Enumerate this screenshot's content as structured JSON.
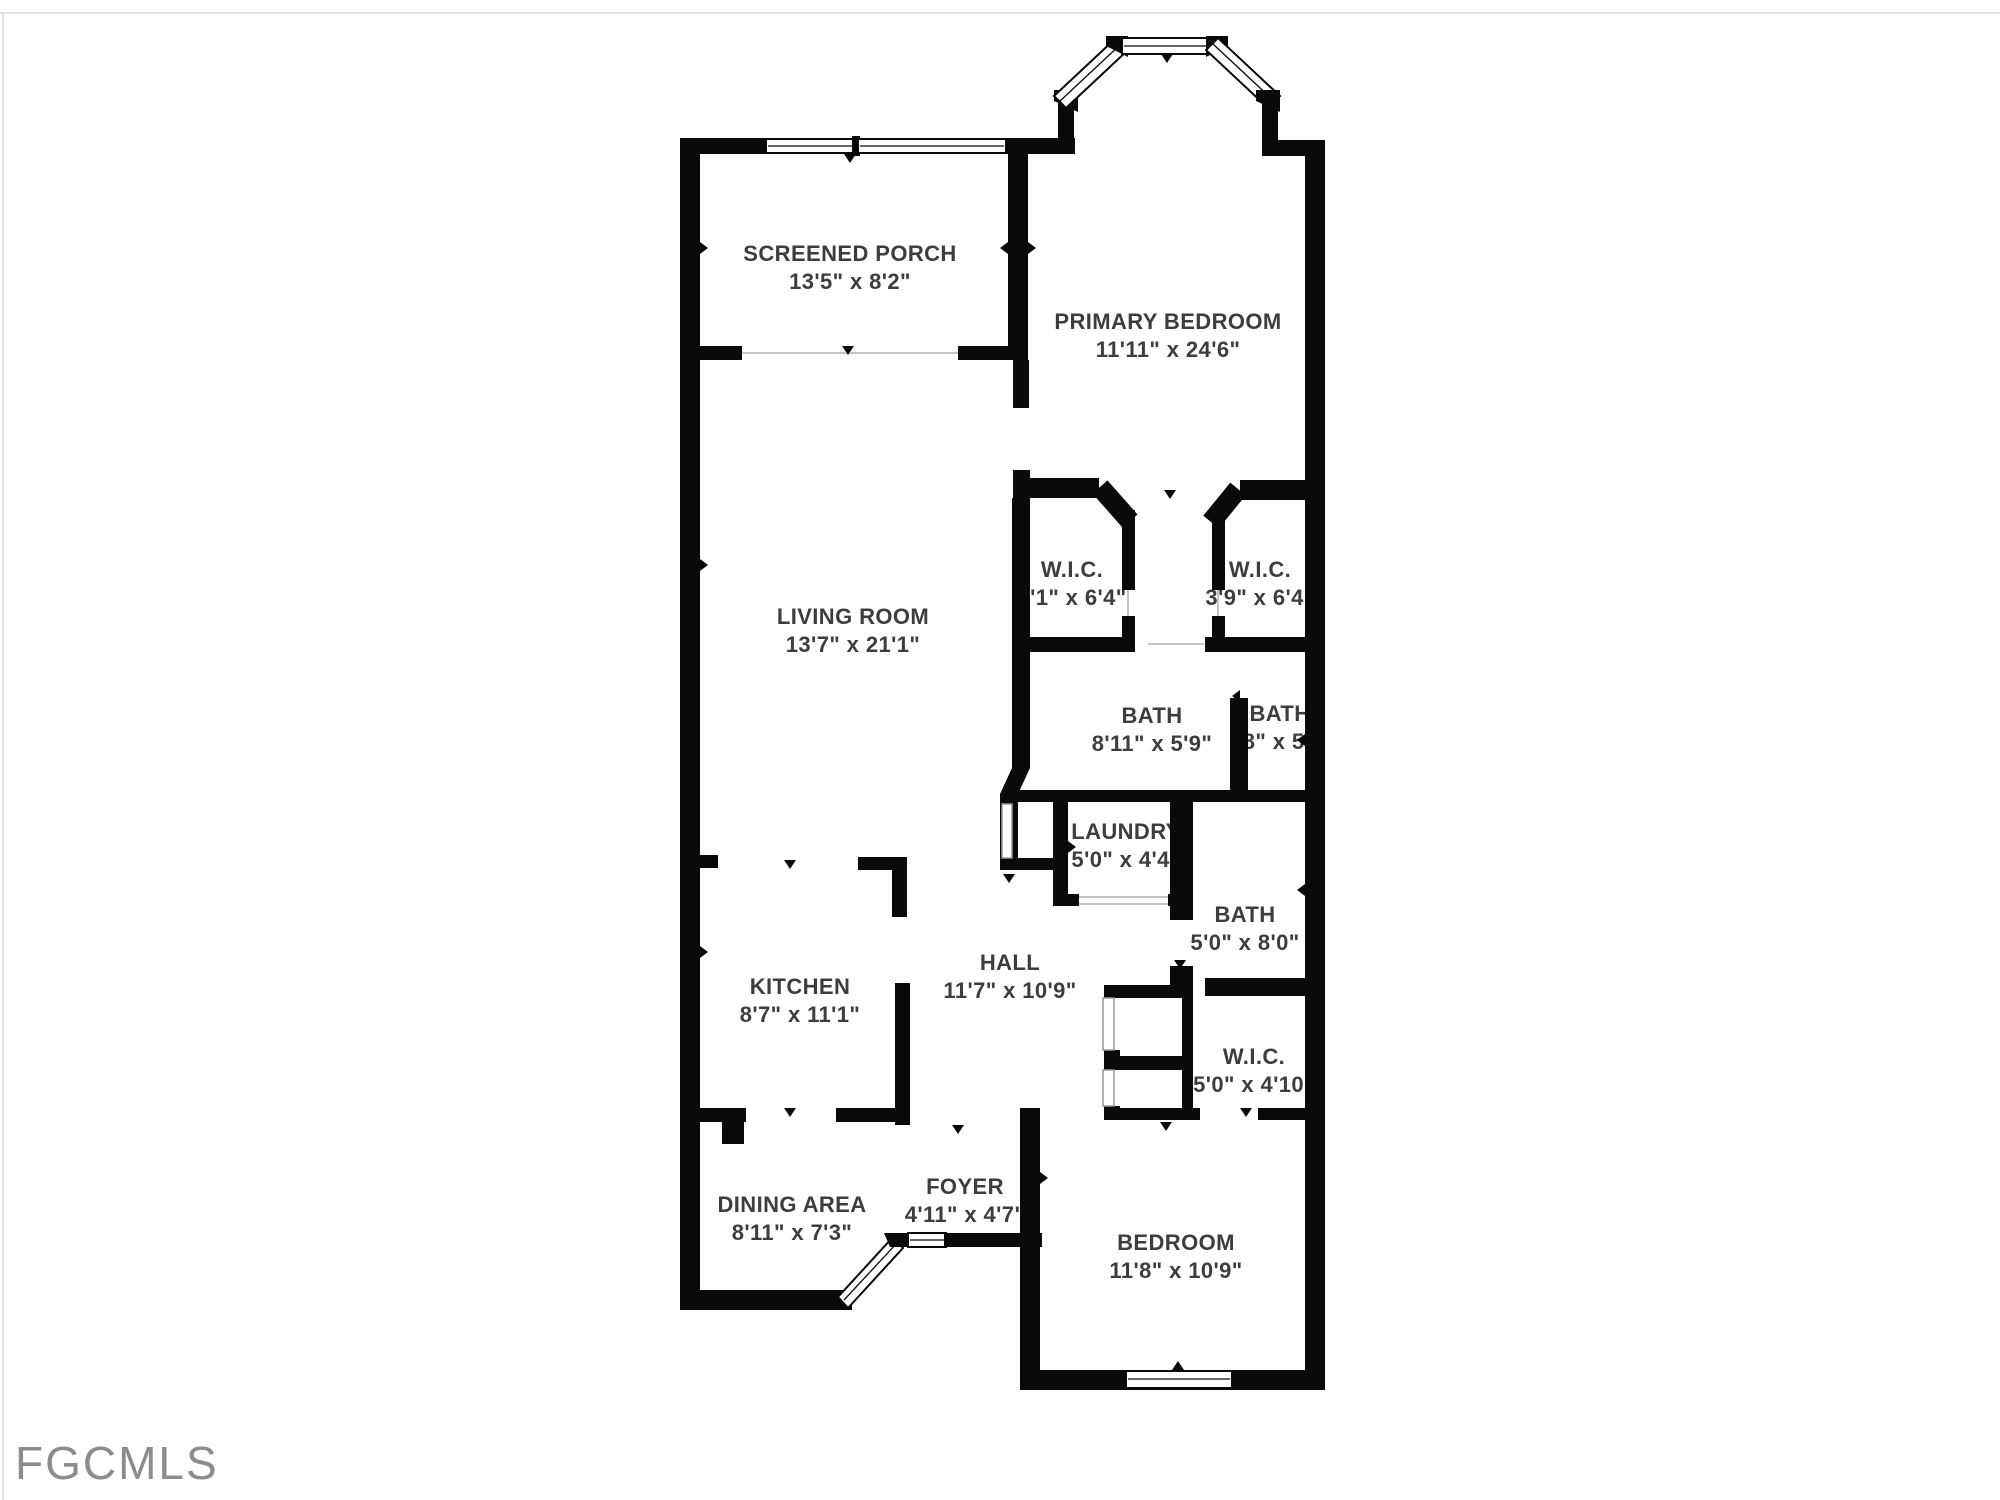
{
  "watermark": "FGCMLS",
  "plan": {
    "rooms": [
      {
        "name": "SCREENED PORCH",
        "dims": "13'5\" x 8'2\""
      },
      {
        "name": "PRIMARY BEDROOM",
        "dims": "11'11\" x 24'6\""
      },
      {
        "name": "LIVING ROOM",
        "dims": "13'7\" x 21'1\""
      },
      {
        "name": "W.I.C.",
        "dims": "4'1\" x 6'4\""
      },
      {
        "name": "W.I.C.",
        "dims": "3'9\" x 6'4\""
      },
      {
        "name": "BATH",
        "dims": "8'11\" x 5'9\""
      },
      {
        "name": "BATH",
        "dims": "'8\" x 5'9"
      },
      {
        "name": "LAUNDRY",
        "dims": "5'0\" x 4'4\""
      },
      {
        "name": "BATH",
        "dims": "5'0\" x 8'0\""
      },
      {
        "name": "HALL",
        "dims": "11'7\" x 10'9\""
      },
      {
        "name": "KITCHEN",
        "dims": "8'7\" x 11'1\""
      },
      {
        "name": "W.I.C.",
        "dims": "5'0\" x 4'10\""
      },
      {
        "name": "DINING AREA",
        "dims": "8'11\" x 7'3\""
      },
      {
        "name": "FOYER",
        "dims": "4'11\" x 4'7\""
      },
      {
        "name": "BEDROOM",
        "dims": "11'8\" x 10'9\""
      }
    ]
  },
  "colors": {
    "wall": "#0a0a0a",
    "label": "#3d3d3d",
    "watermark": "#8c8c8c",
    "open_line": "#c4c4c4"
  }
}
